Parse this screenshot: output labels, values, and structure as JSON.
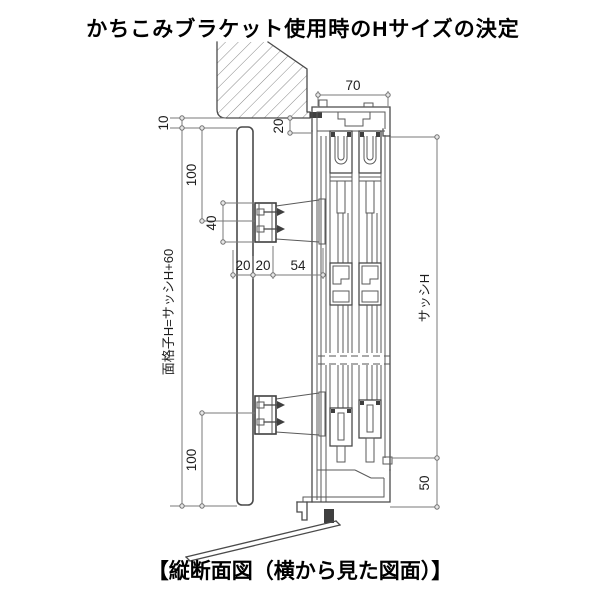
{
  "title": "かちこみブラケット使用時のHサイズの決定",
  "caption": "【縦断面図（横から見た図面）】",
  "drawing": {
    "type": "vertical-cross-section-technical-drawing",
    "subject": "window-lattice-bracket-mounting",
    "dims": {
      "frame_width": "70",
      "top_gap": "10",
      "head_clearance": "20",
      "upper_offset": "100",
      "bracket_height": "40",
      "bar_width": "20",
      "bracket_depth": "20",
      "bracket_to_frame": "54",
      "lower_offset": "100",
      "sill_height": "50",
      "sash_height_label": "サッシH",
      "lattice_height_label": "面格子H=サッシH+60"
    },
    "colors": {
      "background": "#ffffff",
      "line": "#4a4a4a",
      "dimension": "#7a7a7a",
      "text": "#1f1f1f",
      "sealant": "#3f3f3f"
    }
  }
}
